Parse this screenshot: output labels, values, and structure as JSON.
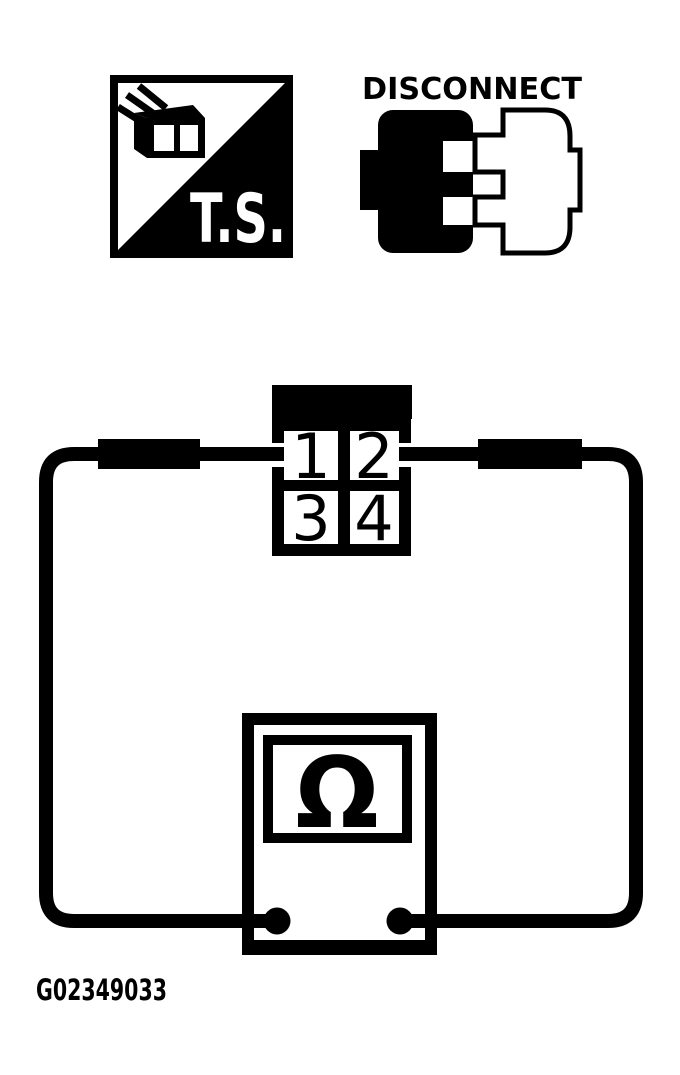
{
  "colors": {
    "ink": "#000000",
    "paper": "#ffffff"
  },
  "symbols": {
    "test_spec": {
      "label": "T.S."
    },
    "disconnect": {
      "label": "DISCONNECT"
    }
  },
  "connector": {
    "pin_labels": [
      "1",
      "2",
      "3",
      "4"
    ]
  },
  "ohmmeter": {
    "display_symbol": "Ω"
  },
  "figure": {
    "id": "G02349033"
  }
}
